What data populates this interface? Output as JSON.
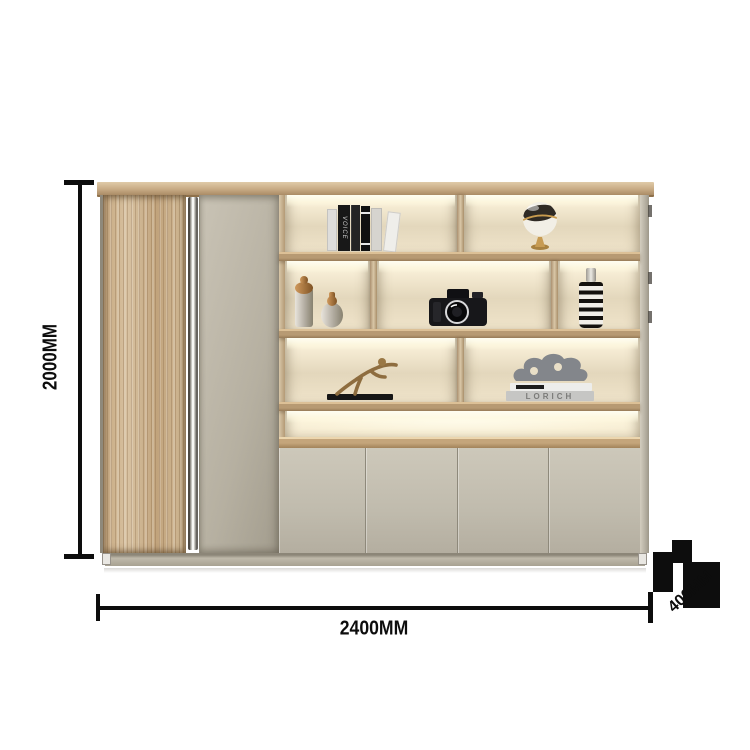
{
  "annotations": {
    "height_label": "2000MM",
    "width_label": "2400MM",
    "depth_label": "400MM",
    "line_color": "#0d0d0d"
  },
  "cabinet": {
    "colors": {
      "wood_door": "#cfb38d",
      "top_panel": "#c8ab85",
      "tall_door": "#b9b3a4",
      "shelf_board": "#b2946f",
      "interior_back": "#ece0c6",
      "led_glow": "#fff8e0",
      "bottom_doors": "#c5c0b2",
      "plinth": "#aaa494",
      "handle_chrome": "#f0f0ee"
    },
    "decor": {
      "books_top": {
        "spine_text": "VOICE"
      },
      "book_stack": {
        "spine_text": "LORICH"
      },
      "items": [
        "books",
        "globe-ornament",
        "mercury-glass-bottles",
        "retro-camera",
        "striped-vase",
        "runner-sculpture",
        "abstract-sculpture-on-books"
      ]
    },
    "structure": {
      "shelf_rows": 4,
      "bottom_door_count": 4
    }
  }
}
